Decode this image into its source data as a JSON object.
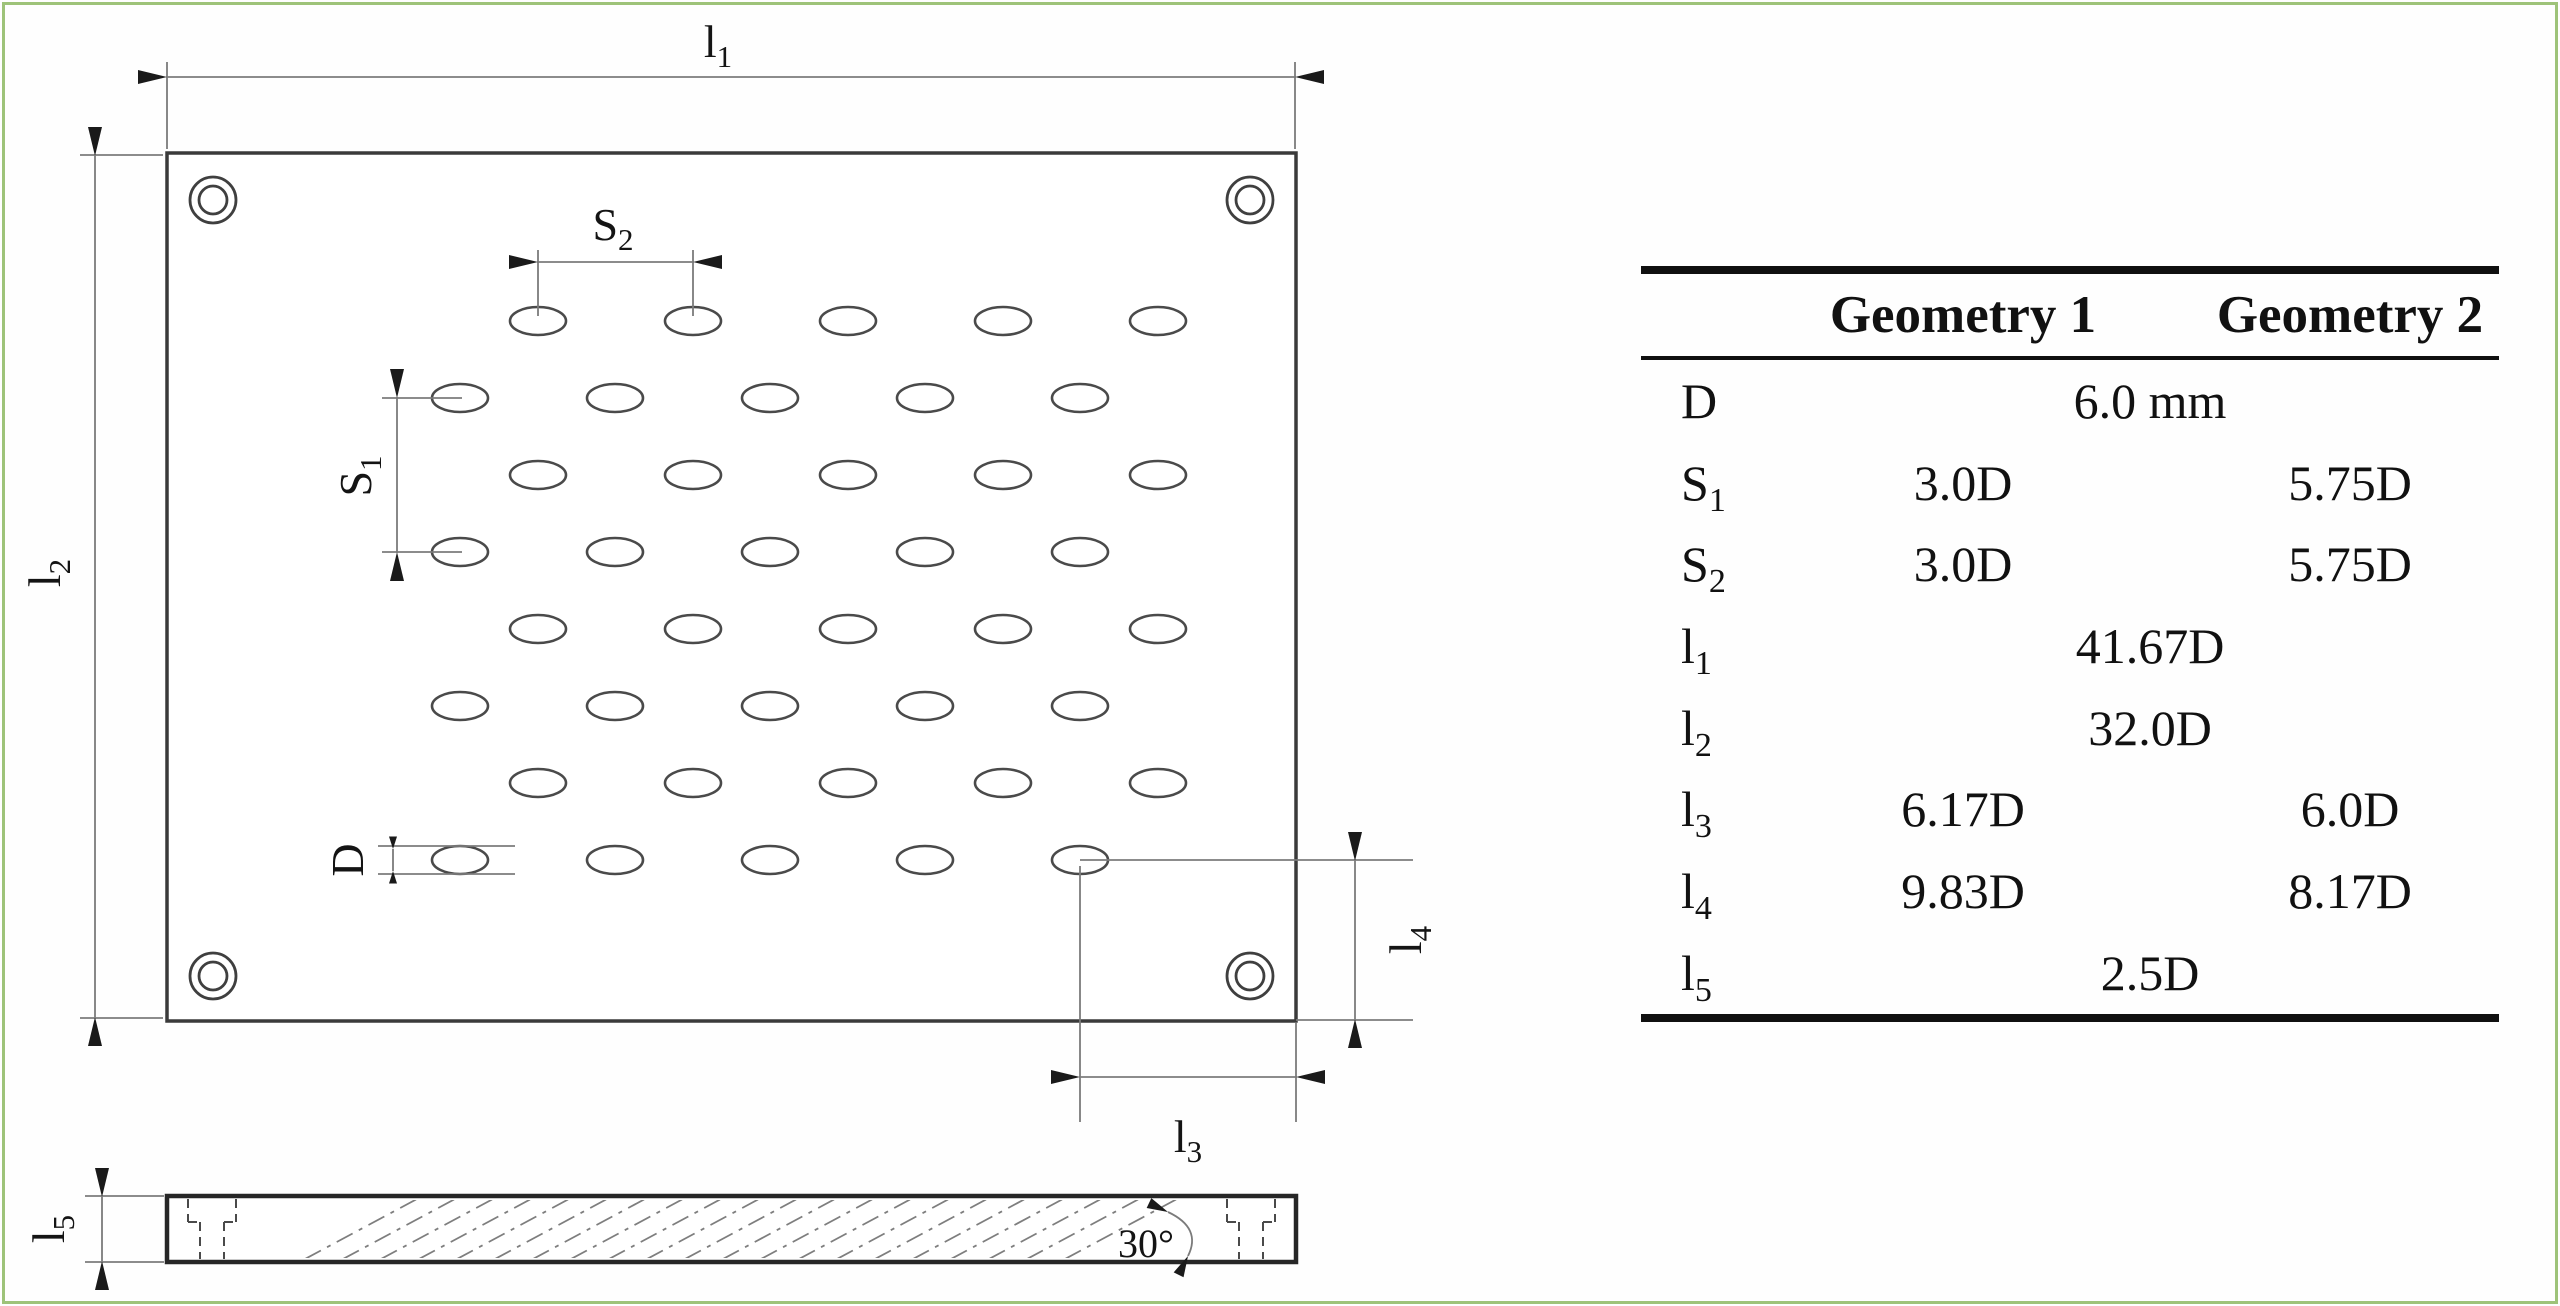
{
  "figure": {
    "dims": {
      "l1": {
        "base": "l",
        "sub": "1"
      },
      "l2": {
        "base": "l",
        "sub": "2"
      },
      "l3": {
        "base": "l",
        "sub": "3"
      },
      "l4": {
        "base": "l",
        "sub": "4"
      },
      "l5": {
        "base": "l",
        "sub": "5"
      },
      "s1": {
        "base": "S",
        "sub": "1"
      },
      "s2": {
        "base": "S",
        "sub": "2"
      },
      "d": {
        "base": "D",
        "sub": ""
      },
      "angle": "30°"
    },
    "pattern": {
      "rx": 28,
      "ry": 14,
      "row_groups": [
        {
          "ys": [
            321,
            475,
            629,
            783
          ],
          "xs": [
            538,
            693,
            848,
            1003,
            1158
          ]
        },
        {
          "ys": [
            398,
            552,
            706,
            860
          ],
          "xs": [
            460,
            615,
            770,
            925,
            1080
          ]
        }
      ]
    },
    "corner_holes": {
      "positions": [
        [
          213,
          200
        ],
        [
          1250,
          200
        ],
        [
          213,
          976
        ],
        [
          1250,
          976
        ]
      ],
      "r_outer": 23,
      "r_inner": 14
    },
    "hatch": {
      "x0": 305,
      "step": 38,
      "count": 21,
      "run": 112,
      "y_bottom": 1259,
      "y_top": 1199
    }
  },
  "table": {
    "headers": {
      "col1": "Geometry 1",
      "col2": "Geometry 2"
    },
    "rows": [
      {
        "label": "D",
        "sub": "",
        "span": "6.0 mm"
      },
      {
        "label": "S",
        "sub": "1",
        "g1": "3.0D",
        "g2": "5.75D"
      },
      {
        "label": "S",
        "sub": "2",
        "g1": "3.0D",
        "g2": "5.75D"
      },
      {
        "label": "l",
        "sub": "1",
        "span": "41.67D"
      },
      {
        "label": "l",
        "sub": "2",
        "span": "32.0D"
      },
      {
        "label": "l",
        "sub": "3",
        "g1": "6.17D",
        "g2": "6.0D"
      },
      {
        "label": "l",
        "sub": "4",
        "g1": "9.83D",
        "g2": "8.17D"
      },
      {
        "label": "l",
        "sub": "5",
        "span": "2.5D"
      }
    ]
  },
  "colors": {
    "page_border": "#9ec379",
    "drawing_line": "#3a3a3a",
    "dim_line": "#7b7b7b",
    "arrow": "#1a1a1a",
    "text": "#111111",
    "background": "#fefefe"
  }
}
